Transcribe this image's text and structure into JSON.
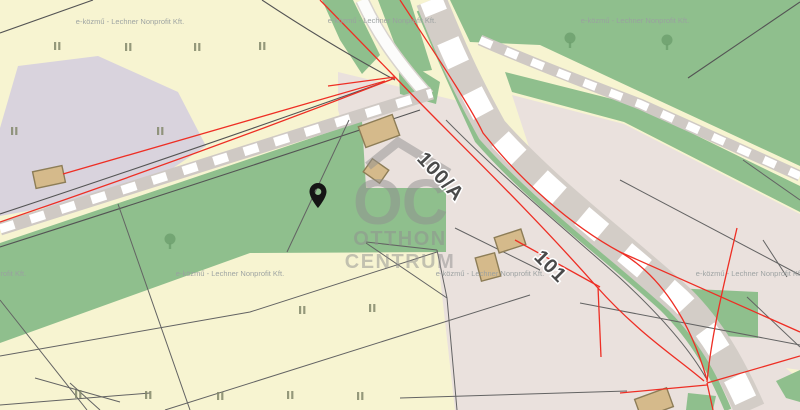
{
  "map": {
    "parcel_labels": {
      "a": "100/A",
      "b": "101"
    },
    "watermark": {
      "attribution": "e-közmű - Lechner Nonprofit Kft."
    },
    "logo": {
      "initials": "OC",
      "line1": "OTTHON",
      "line2": "CENTRUM"
    },
    "marker": {
      "icon": "location-pin",
      "color": "#151515"
    },
    "icons": {
      "vegetation": "tree-icon",
      "crop_rows": "vineyard-rows-icon",
      "buildings": "building-icon",
      "brand": "roof-icon"
    },
    "palette": {
      "farmland": "#f7f4d1",
      "meadow": "#8fbf8d",
      "forest": "#8fbf8d",
      "tree_icon": "#6fa06e",
      "residential": "#eae1dd",
      "farmyard": "#d9d3dd",
      "road_base": "#cfc9c4",
      "road_dash": "#ffffff",
      "footpath": "#fcfcfb",
      "cadastral_red": "#ee2e24",
      "parcel_line_gray": "#636363",
      "building_fill": "#d5ba8b",
      "building_stroke": "#8d7d57",
      "label_text": "#4a4a4a",
      "watermark_gray": "#9aa0a0",
      "logo_gray": "#8f8f8f"
    }
  }
}
